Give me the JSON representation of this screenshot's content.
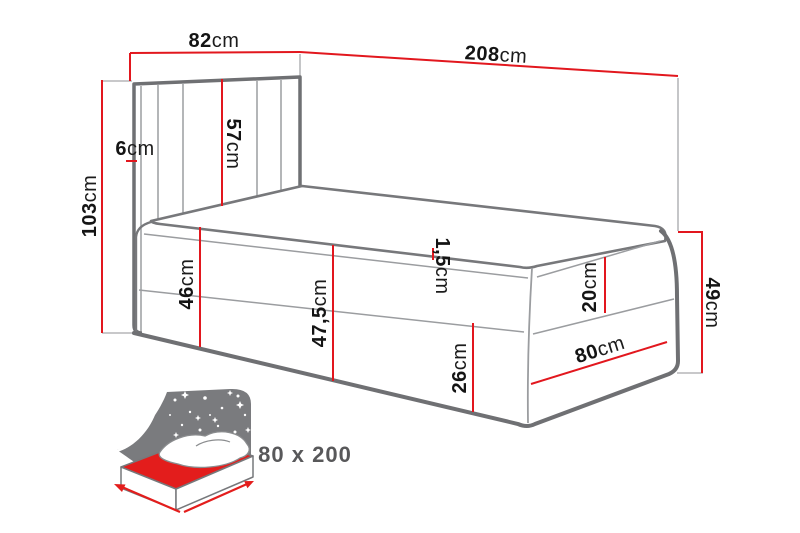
{
  "diagram": {
    "type": "bed-dimension-drawing",
    "dims": {
      "headboard_width": {
        "value": "82",
        "unit": "cm"
      },
      "total_length": {
        "value": "208",
        "unit": "cm"
      },
      "total_height": {
        "value": "103",
        "unit": "cm"
      },
      "side_thickness": {
        "value": "6",
        "unit": "cm"
      },
      "headboard_height": {
        "value": "57",
        "unit": "cm"
      },
      "seat_height_head": {
        "value": "46",
        "unit": "cm"
      },
      "seat_height_foot": {
        "value": "47,5",
        "unit": "cm"
      },
      "piping_height": {
        "value": "1,5",
        "unit": "cm"
      },
      "mattress_band": {
        "value": "20",
        "unit": "cm"
      },
      "footboard_height": {
        "value": "49",
        "unit": "cm"
      },
      "base_height": {
        "value": "26",
        "unit": "cm"
      },
      "bed_width": {
        "value": "80",
        "unit": "cm"
      }
    },
    "size_badge": "80 x 200",
    "colors": {
      "dimension_red": "#e2171e",
      "outline_gray": "#6f7073",
      "seam_gray": "#9b9da0",
      "icon_gray": "#7a7b7e",
      "badge_text": "#58585a",
      "icon_red": "#e31d1c"
    }
  }
}
